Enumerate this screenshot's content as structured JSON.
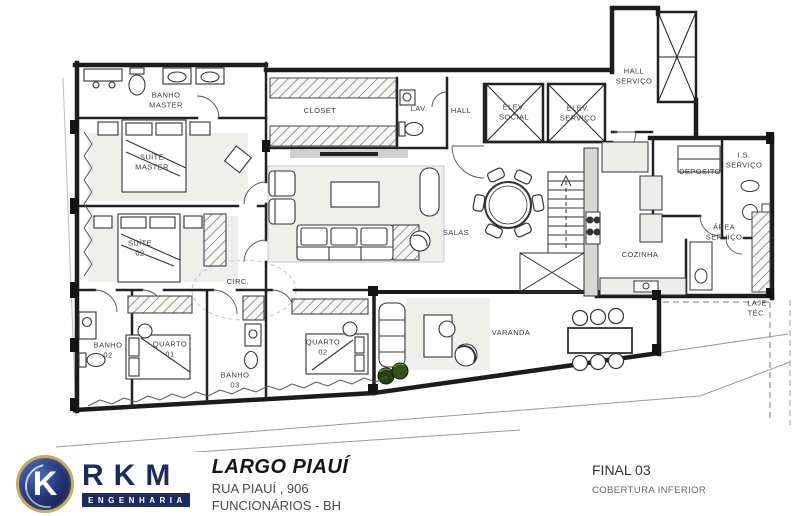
{
  "plan": {
    "labels": {
      "banho_master": "BANHO\nMASTER",
      "suite_master": "SUÍTE\nMASTER",
      "suite_02": "SUÍTE\n02",
      "closet": "CLOSET",
      "lav": "LAV.",
      "hall": "HALL",
      "elev_social": "ELEV.\nSOCIAL",
      "elev_servico": "ELEV.\nSERVIÇO",
      "hall_servico": "HALL\nSERVIÇO",
      "deposito": "DEPOSITO",
      "is_servico": "I.S.\nSERVIÇO",
      "area_servico": "ÁREA\nSERVIÇO",
      "cozinha": "COZINHA",
      "laje_tec": "LAJE\nTÉC.",
      "salas": "SALAS",
      "circ": "CIRC.",
      "banho_02": "BANHO\n02",
      "quarto_01": "QUARTO\n01",
      "banho_03": "BANHO\n03",
      "quarto_02": "QUARTO\n02",
      "varanda": "VARANDA"
    }
  },
  "title_block": {
    "logo_k": "K",
    "logo_rkm": "RKM",
    "logo_sub": "ENGENHARIA",
    "project_name": "LARGO PIAUÍ",
    "address": "RUA PIAUÍ , 906",
    "district": "FUNCIONÁRIOS - BH",
    "unit": "FINAL 03",
    "level": "COBERTURA INFERIOR"
  },
  "colors": {
    "navy": "#1d2a5e",
    "gold": "#c7ab5e",
    "wall": "#1c1c1c",
    "plant_green": "#2c4f17"
  }
}
